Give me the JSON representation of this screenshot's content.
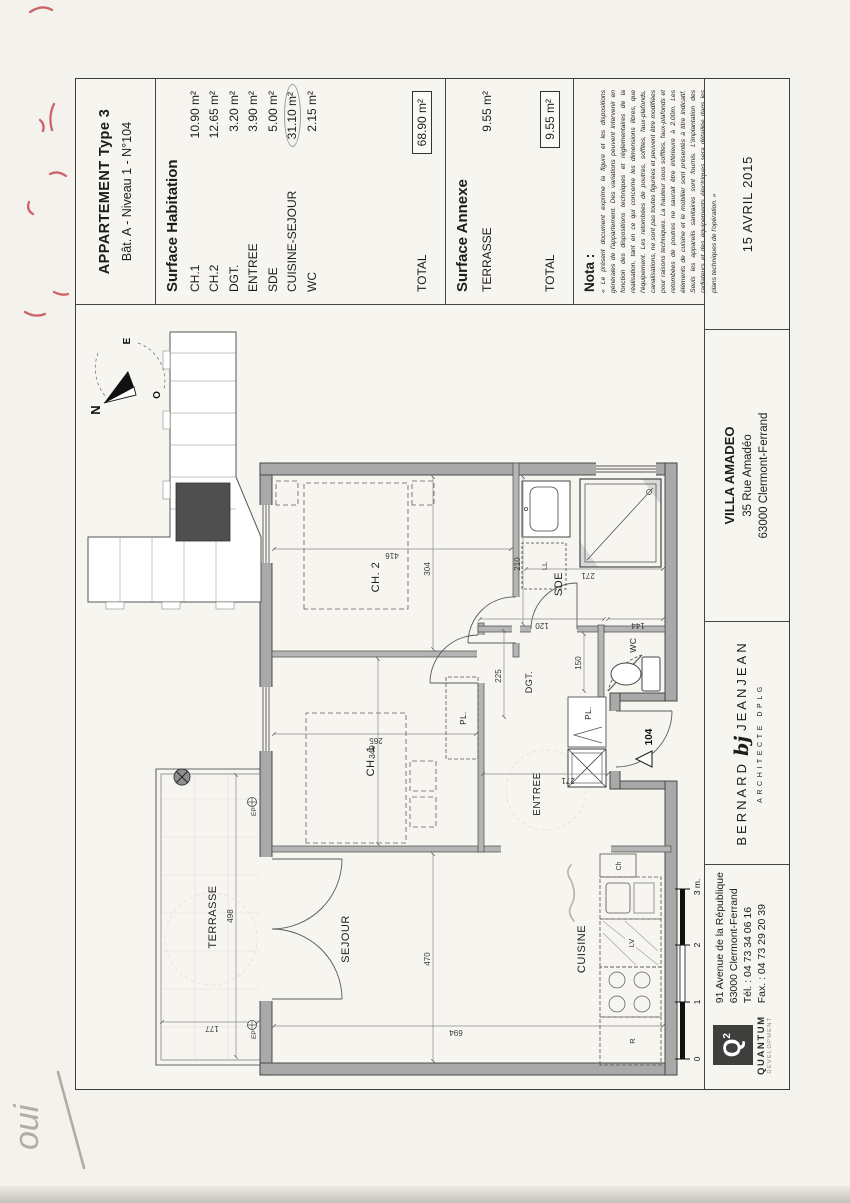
{
  "document": {
    "title_block": {
      "line1": "APPARTEMENT Type 3",
      "line2": "Bât. A - Niveau 1 - N°104"
    },
    "surface_habitation": {
      "heading": "Surface Habitation",
      "rows": [
        {
          "label": "CH.1",
          "value": "10.90 m²"
        },
        {
          "label": "CH.2",
          "value": "12.65 m²"
        },
        {
          "label": "DGT.",
          "value": "3.20 m²"
        },
        {
          "label": "ENTREE",
          "value": "3.90 m²"
        },
        {
          "label": "SDE",
          "value": "5.00 m²"
        },
        {
          "label": "CUISINE-SEJOUR",
          "value": "31.10 m²"
        },
        {
          "label": "WC",
          "value": "2.15 m²"
        }
      ],
      "total_label": "TOTAL",
      "total_value": "68.90 m²"
    },
    "surface_annexe": {
      "heading": "Surface Annexe",
      "rows": [
        {
          "label": "TERRASSE",
          "value": "9.55 m²"
        }
      ],
      "total_label": "TOTAL",
      "total_value": "9.55 m²"
    },
    "nota": {
      "heading": "Nota :",
      "body": "« Le présent document exprime la figure et les dispositions générales de l'appartement. Des variations peuvent intervenir en fonction des dispositions techniques et réglementaires de la réalisation, tant en ce qui concerne les dimensions libres, que l'équipement. Les retombées de poutres, soffites, faux-plafonds, canalisations, ne sont pas toutes figurées et peuvent être modifiées pour raisons techniques. La hauteur sous soffites, faux-plafonds et retombées de poutres ne saurait être inférieure à 2.00m. Les éléments de cuisine et le mobilier sont présentés à titre indicatif. Seuls les appareils sanitaires sont fournis. L'implantation des radiateurs et des équipements électriques sera détaillée dans les plans techniques de l'opération. »"
    },
    "date": "15 AVRIL 2015",
    "project": {
      "name": "VILLA AMADEO",
      "address1": "35 Rue Amadéo",
      "address2": "63000 Clermont-Ferrand"
    },
    "architect": {
      "name1": "BERNARD",
      "glyph": "bj",
      "name2": "JEANJEAN",
      "subtitle": "ARCHITECTE DPLG"
    },
    "developer": {
      "logo_letter": "Q",
      "logo_sup": "2",
      "name": "QUANTUM",
      "subname": "DEVELOPMENT",
      "addr1": "91 Avenue de la République",
      "addr2": "63000 Clermont-Ferrand",
      "addr3": "Tél. : 04 73 34 06 16",
      "addr4": "Fax. : 04 73 29 20 39"
    }
  },
  "plan": {
    "rooms": {
      "terrasse": "TERRASSE",
      "sejour": "SEJOUR",
      "cuisine": "CUISINE",
      "ch1": "CH. 1",
      "ch2": "CH. 2",
      "sde": "SDE",
      "wc": "WC",
      "entree": "ENTREE",
      "dgt": "DGT.",
      "pl": "PL."
    },
    "dims": {
      "terrasse_w": "498",
      "terrasse_d": "177",
      "sejour_w": "470",
      "overall_d": "694",
      "ch1_w": "349",
      "ch1_d": "265",
      "ch2_w": "304",
      "ch2_d": "416",
      "sde_w": "210",
      "sde_d": "271",
      "dgt_seg": "120",
      "wc_seg": "144",
      "wc_w": "150",
      "dgt_w": "225",
      "entree_d": "271"
    },
    "fixtures": {
      "ll": "LL",
      "lv": "LV",
      "fridge": "R",
      "ch": "Ch"
    },
    "markers": {
      "ep": "EP",
      "unit": "104"
    },
    "compass": {
      "n": "N",
      "e": "E",
      "o": "O"
    },
    "scale": {
      "t0": "0",
      "t1": "1",
      "t2": "2",
      "t3": "3 m."
    }
  },
  "annotations": {
    "handwritten_note": "oui"
  },
  "colors": {
    "wall_fill": "#a9a9a9",
    "line_dark": "#3d3d3d",
    "red_ink": "#c94f5a",
    "pencil": "#b0ada5"
  }
}
